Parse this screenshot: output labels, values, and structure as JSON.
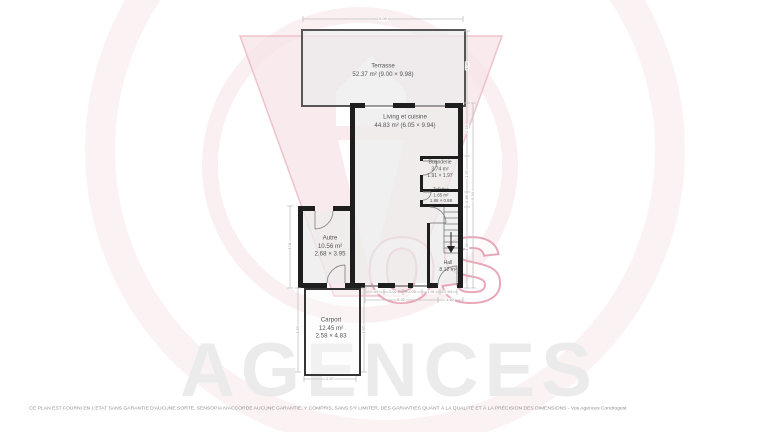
{
  "watermark": {
    "word": "Vos",
    "suffix_rendered": "os",
    "brand": "AGENCES"
  },
  "rooms": [
    {
      "name": "Terrasse",
      "line2": "52.37 m² (9.00 × 9.98)",
      "line3": ""
    },
    {
      "name": "Living et cuisine",
      "line2": "44.83 m² (6.05 × 9.94)",
      "line3": ""
    },
    {
      "name": "Buanderie",
      "line2": "3.74 m²",
      "line3": "1.91 × 1.97"
    },
    {
      "name": "Toilettes",
      "line2": "1.65 m²",
      "line3": "1.88 × 0.88"
    },
    {
      "name": "Autre",
      "line2": "10.56 m²",
      "line3": "2.68 × 3.95"
    },
    {
      "name": "Hall",
      "line2": "8.12 m²",
      "line3": ""
    },
    {
      "name": "Carport",
      "line2": "12.45 m²",
      "line3": "2.58 × 4.83"
    }
  ],
  "dimensions": {
    "top": "9.00",
    "terrace_right": "4.03",
    "right_chain": [
      "2.53",
      "1.97",
      "0.88",
      "4.46"
    ],
    "right_total": "9.94",
    "bottom_row1": [
      "0.94",
      "2.02",
      "2.05",
      "1.91",
      "0.94"
    ],
    "bottom_row2": [
      "6.32",
      "1.60"
    ],
    "autre_left": "4.01",
    "carport_left": "4.83",
    "carport_right": "4.83",
    "carport_bottom": "2.57"
  },
  "footer": {
    "disclaimer": "CE PLAN EST FOURNI EN L'ETAT SANS GARANTIE D'AUCUNE SORTE. SENSOPIA N'ACCORDE AUCUNE GARANTIE, Y COMPRIS, SANS S'Y LIMITER, DES GARANTIES QUANT À LA QUALITÉ ET À LA PRÉCISION DES DIMENSIONS - Vos Agences Condrogest"
  },
  "colors": {
    "wall": "#1e1e1e",
    "terrace-border": "#565656",
    "carport-border": "#343434",
    "dim-line": "#c0c0c0",
    "label-text": "#545454",
    "wm-pink": "#eab6c0",
    "wm-pink-light": "#f6e3e7",
    "wm-gray": "#ebebeb"
  }
}
